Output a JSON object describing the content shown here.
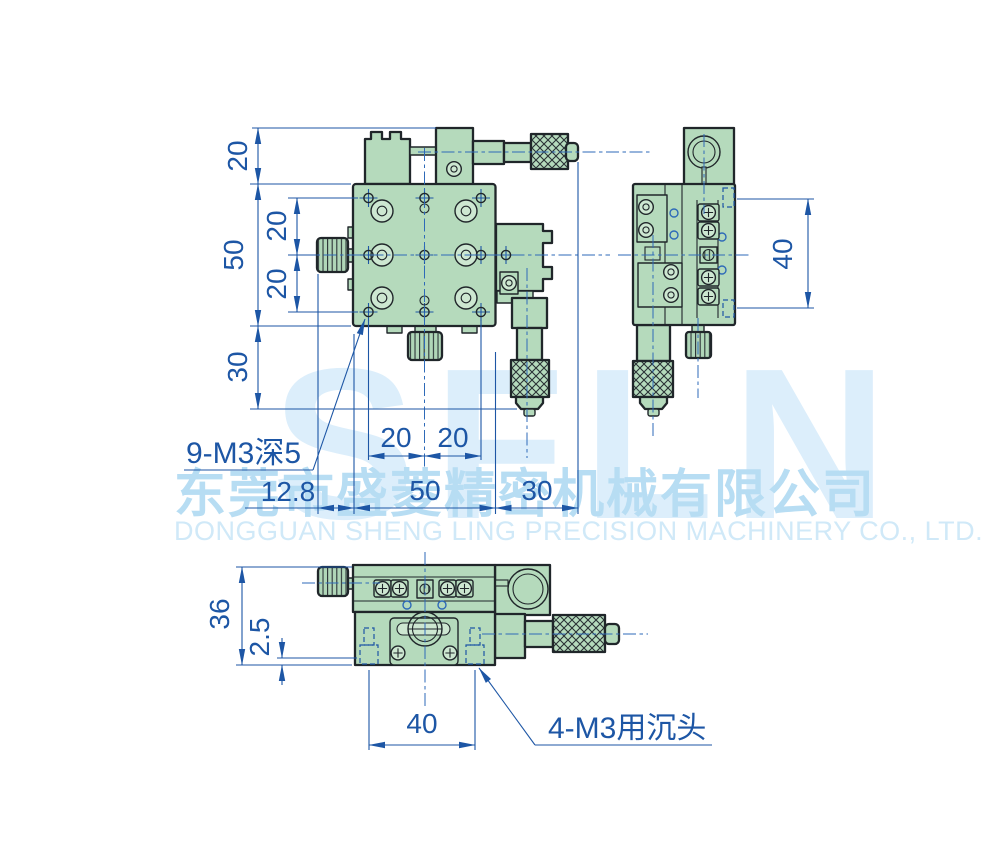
{
  "watermark": {
    "logo_text": "SFLN",
    "company_cn": "东莞市盛菱精密机械有限公司",
    "company_en": "DONGGUAN SHENG LING PRECISION MACHINERY CO., LTD."
  },
  "dimensions": {
    "front_top_offset": "20",
    "front_body_height": "50",
    "front_row_gap_upper": "20",
    "front_row_gap_lower": "20",
    "front_bottom_offset": "30",
    "front_col_gap_left": "20",
    "front_col_gap_right": "20",
    "front_left_knob": "12.8",
    "front_body_width": "50",
    "front_right_offset": "30",
    "side_hole_span": "40",
    "bottom_body_height": "36",
    "bottom_recess_depth": "2.5",
    "bottom_hole_span": "40"
  },
  "callouts": {
    "front_thread_holes": "9-M3深5",
    "bottom_countersunk_holes": "4-M3用沉头"
  },
  "colors": {
    "body_green": "#b5dabc",
    "body_green_light": "#cde7d1",
    "outline": "#20262a",
    "dimension_blue": "#1d56a5",
    "centerline_blue": "#2e6ab8",
    "watermark_logo": "#dceefb",
    "watermark_cn": "#b7ddf3",
    "watermark_en": "#d0e9f8"
  }
}
